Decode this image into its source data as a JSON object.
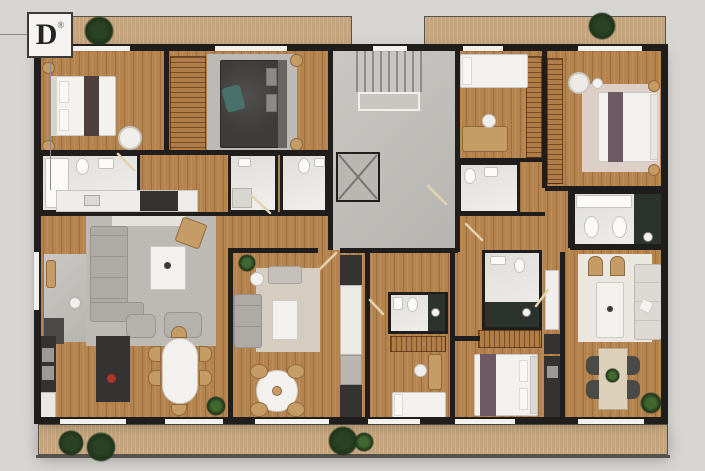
{
  "logo": {
    "letter": "D",
    "registered": "®"
  },
  "palette": {
    "background": "#d7d5d1",
    "wall": "#201e1c",
    "wood": "#b5834e",
    "balcony": "#c5a47c",
    "tile": "#eceae6",
    "concrete": "#c2c0bb",
    "rug_gray": "#bdbab5",
    "rug_beige": "#d5cdc0",
    "rug_pink": "#dccfc8",
    "rug_white": "#eae7e1",
    "sofa_gray": "#aeaba6",
    "sofa_white": "#dcd9d3",
    "furn_white": "#f2f1ee",
    "dark_fixture": "#343331",
    "wood_furn": "#c59b66",
    "wardrobe": "#b07c48",
    "plant_dark": "#20351c",
    "plant_green": "#41692f",
    "teal": "#49706b",
    "runner_brown": "#4e3e3c",
    "runner_mauve": "#6e5a62",
    "accent_red": "#b23527",
    "window": "#f2f1ee",
    "bed_dark": "#3d3c3a",
    "line": "#8b8885"
  }
}
